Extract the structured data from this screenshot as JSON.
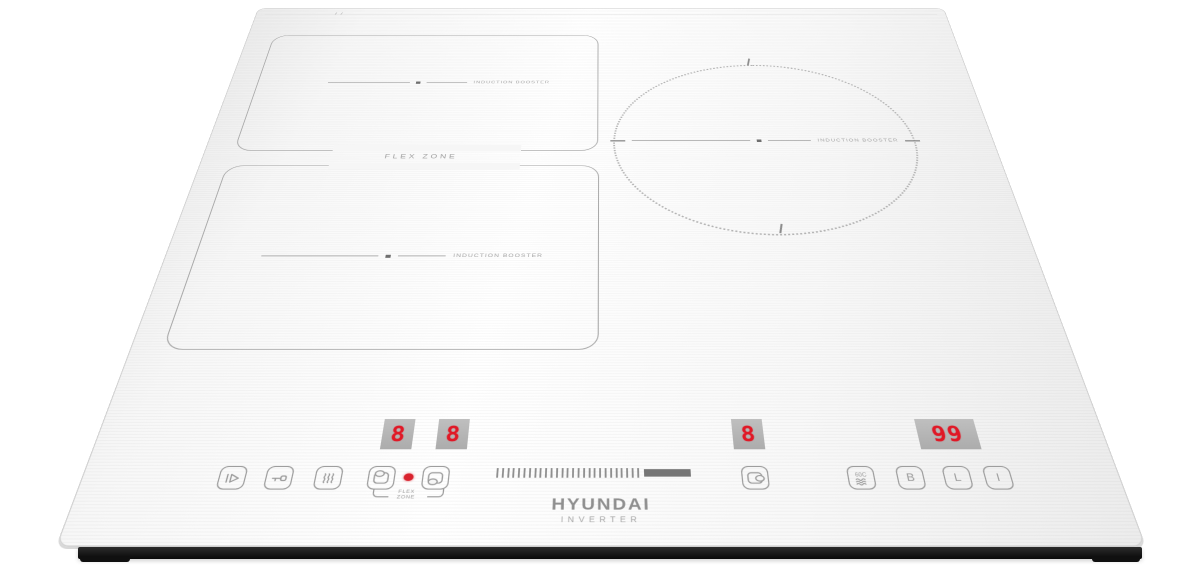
{
  "product": {
    "brand": "HYUNDAI",
    "tagline": "INVERTER"
  },
  "surface": {
    "flex_zone_label": "FLEX ZONE",
    "zone_labels": {
      "upper_left": "INDUCTION BOOSTER",
      "lower_left": "INDUCTION BOOSTER",
      "right": "INDUCTION BOOSTER"
    }
  },
  "displays": {
    "flex_upper_level": "8",
    "flex_lower_level": "8",
    "right_zone_level": "8",
    "timer_value": "99"
  },
  "controls": {
    "flex_led_label": {
      "line1": "FLEX",
      "line2": "ZONE"
    },
    "buttons": {
      "pause": "pause-play-icon",
      "child_lock": "key-icon",
      "keep_warm": "steam-waves-icon",
      "flex_upper_zone": "pot-top-zone-icon",
      "flex_lower_zone": "pot-bottom-zone-icon",
      "right_zone": "pot-right-zone-icon",
      "keep_warm_60": "60C",
      "boost": "B",
      "lock": "L",
      "power": "I"
    }
  },
  "colors": {
    "glass": "#f6f6f6",
    "digit_red": "#e01826",
    "led_red": "#d9232e",
    "icon_gray": "#9a9a9a",
    "base_black": "#101010"
  }
}
